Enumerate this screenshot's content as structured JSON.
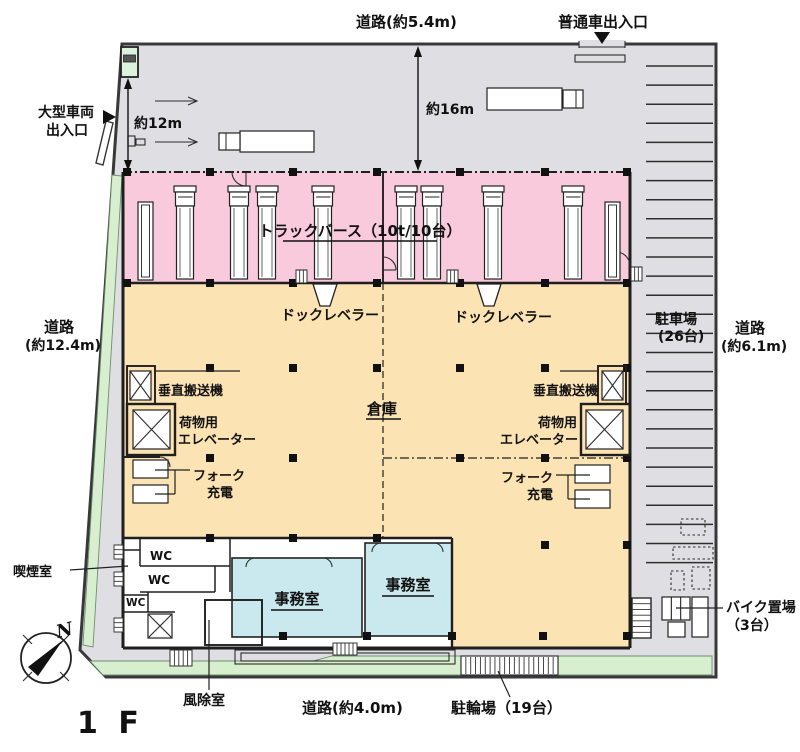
{
  "colors": {
    "site_gray": "#dfdee2",
    "berth_pink": "#f9c9dc",
    "warehouse_beige": "#fce3b3",
    "office_blue": "#c9e9ef",
    "green": "#d8efcf",
    "guard_green": "#dcf2dc"
  },
  "top": {
    "road": "道路(約5.4m)",
    "car_entrance": "普通車出入口",
    "dim16": "約16m"
  },
  "left": {
    "large_vehicle_1": "大型車両",
    "large_vehicle_2": "出入口",
    "dim12": "約12m",
    "road_1": "道路",
    "road_2": "(約12.4m)",
    "smoking_room": "喫煙室"
  },
  "right": {
    "parking_1": "駐車場",
    "parking_2": "(26台)",
    "parking_stalls": 26,
    "road_1": "道路",
    "road_2": "(約6.1m)",
    "bike_1": "バイク置場",
    "bike_2": "（3台）",
    "bike_stalls": 3
  },
  "bottom": {
    "road": "道路(約4.0m)",
    "bicycle": "駐輪場（19台）",
    "bicycle_stalls": 19,
    "windbreak": "風除室",
    "floor": "1 F",
    "north": "N"
  },
  "building": {
    "truck_berth": "トラックバース（10t/10台）",
    "dock_leveler_left": "ドックレベラー",
    "dock_leveler_right": "ドックレベラー",
    "conveyor_left": "垂直搬送機",
    "conveyor_right": "垂直搬送機",
    "elevator_left_1": "荷物用",
    "elevator_left_2": "エレベーター",
    "elevator_right_1": "荷物用",
    "elevator_right_2": "エレベーター",
    "fork_left_1": "フォーク",
    "fork_left_2": "充電",
    "fork_right_1": "フォーク",
    "fork_right_2": "充電",
    "warehouse": "倉庫",
    "office_left": "事務室",
    "office_right": "事務室",
    "wc_1": "WC",
    "wc_2": "WC",
    "wc_3": "WC"
  }
}
